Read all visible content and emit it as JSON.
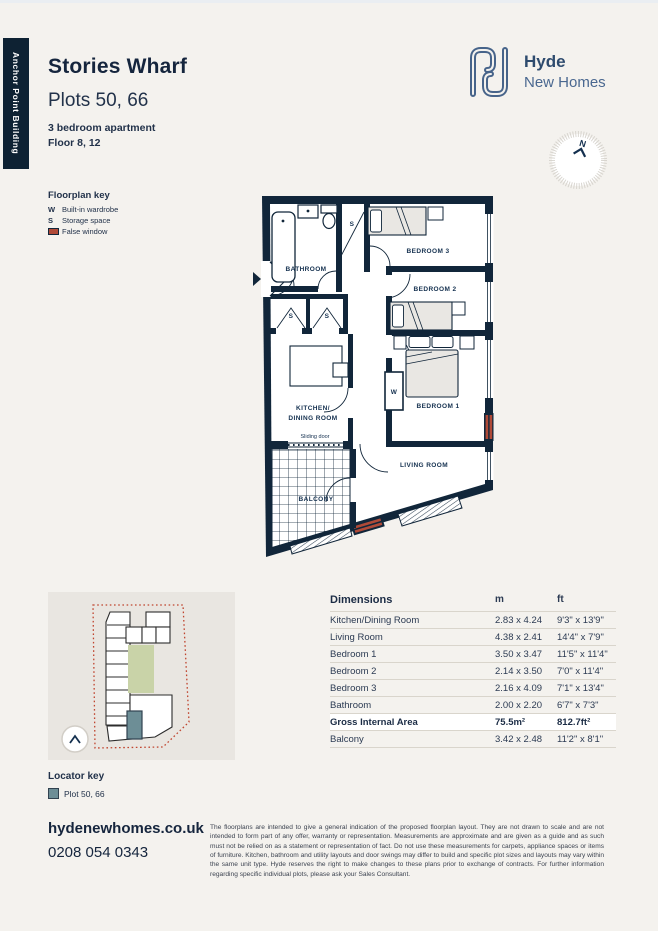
{
  "page": {
    "building_tag": "Anchor Point Building"
  },
  "header": {
    "title": "Stories Wharf",
    "plots": "Plots 50, 66",
    "type": "3 bedroom apartment",
    "floor": "Floor 8, 12"
  },
  "logo": {
    "name": "Hyde",
    "sub": "New Homes"
  },
  "compass": {
    "north": "N"
  },
  "colors": {
    "navy": "#11263a",
    "accent_red": "#b04a38",
    "plot_teal": "#6d8e96",
    "site_green": "#c9d3a8",
    "page_bg": "#f4f2ee"
  },
  "floorplan_key": {
    "title": "Floorplan key",
    "items": [
      {
        "symbol": "W",
        "label": "Built-in wardrobe"
      },
      {
        "symbol": "S",
        "label": "Storage space"
      },
      {
        "symbol": "swatch",
        "label": "False window"
      }
    ]
  },
  "floorplan": {
    "bathroom": "BATHROOM",
    "bedroom3": "BEDROOM 3",
    "bedroom2": "BEDROOM 2",
    "bedroom1": "BEDROOM 1",
    "kitchen_line1": "KITCHEN/",
    "kitchen_line2": "DINING ROOM",
    "sliding_door": "Sliding door",
    "balcony": "BALCONY",
    "living": "LIVING ROOM",
    "wardrobe": "W",
    "storage": "S"
  },
  "dimensions": {
    "title": "Dimensions",
    "col_m": "m",
    "col_ft": "ft",
    "rows": [
      {
        "name": "Kitchen/Dining Room",
        "m": "2.83 x 4.24",
        "ft": "9'3\" x 13'9\""
      },
      {
        "name": "Living Room",
        "m": "4.38 x 2.41",
        "ft": "14'4\" x 7'9\""
      },
      {
        "name": "Bedroom 1",
        "m": "3.50 x 3.47",
        "ft": "11'5\" x 11'4\""
      },
      {
        "name": "Bedroom 2",
        "m": "2.14 x 3.50",
        "ft": "7'0\" x 11'4\""
      },
      {
        "name": "Bedroom 3",
        "m": "2.16 x 4.09",
        "ft": "7'1\" x 13'4\""
      },
      {
        "name": "Bathroom",
        "m": "2.00 x 2.20",
        "ft": "6'7\" x 7'3\""
      },
      {
        "name": "Gross Internal Area",
        "m": "75.5m²",
        "ft": "812.7ft²",
        "highlight": true
      },
      {
        "name": "Balcony",
        "m": "3.42 x 2.48",
        "ft": "11'2\" x 8'1\""
      }
    ]
  },
  "locator": {
    "key_title": "Locator key",
    "key_label": "Plot 50, 66"
  },
  "footer": {
    "website": "hydenewhomes.co.uk",
    "phone": "0208 054 0343",
    "disclaimer": "The floorplans are intended to give a general indication of the proposed floorplan layout. They are not drawn to scale and are not intended to form part of any offer, warranty or representation. Measurements are approximate and are given as a guide and as such must not be relied on as a statement or representation of fact. Do not use these measurements for carpets, appliance spaces or items of furniture. Kitchen, bathroom and utility layouts and door swings may differ to build and specific plot sizes and layouts may vary within the same unit type. Hyde reserves the right to make changes to these plans prior to exchange of contracts. For further information regarding specific individual plots, please ask your Sales Consultant."
  }
}
